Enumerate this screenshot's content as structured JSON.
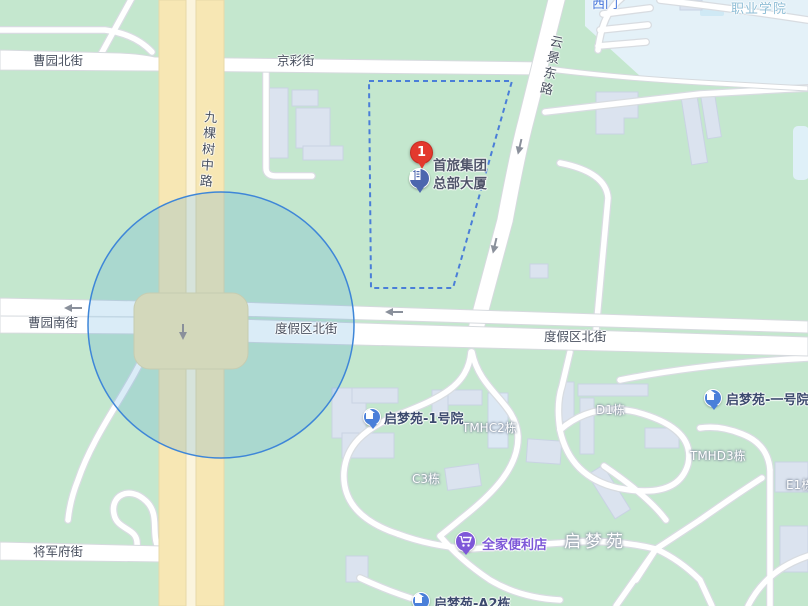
{
  "marker": {
    "number": "1",
    "title_line1": "首旅集团",
    "title_line2": "总部大厦"
  },
  "streets": {
    "caoyuan_north": "曹园北街",
    "jingcai": "京彩街",
    "jiukeshu": "九棵树中路",
    "yunjing": "云景东路",
    "caoyuan_south": "曹园南街",
    "dujiaqu_west": "度假区北街",
    "dujiaqu_east": "度假区北街",
    "jiangjunfu": "将军府街"
  },
  "areas": {
    "college": "职业学院",
    "west_gate": "西门",
    "community": "启梦苑"
  },
  "buildings": {
    "tmhc2": "TMHC2栋",
    "d1": "D1栋",
    "tmhd3": "TMHD3栋",
    "e1": "E1栋",
    "c3": "C3栋"
  },
  "pois": {
    "qmy_no1_yard": "启梦苑-1号院",
    "qmy_yihao_yard": "启梦苑-一号院",
    "qmy_a2": "启梦苑-A2栋",
    "familymart": "全家便利店"
  },
  "colors": {
    "land": "#c4e7ce",
    "campus": "#e4f1f8",
    "main_road": "#f7e7b4",
    "minor_road": "#ffffff",
    "building": "#dbe3ef",
    "selection_circle": "#3e86d8",
    "boundary_dash": "#4a7ed8",
    "marker_red": "#e3392e",
    "poi_blue": "#4a7fd9",
    "poi_purple": "#7e57d8"
  }
}
